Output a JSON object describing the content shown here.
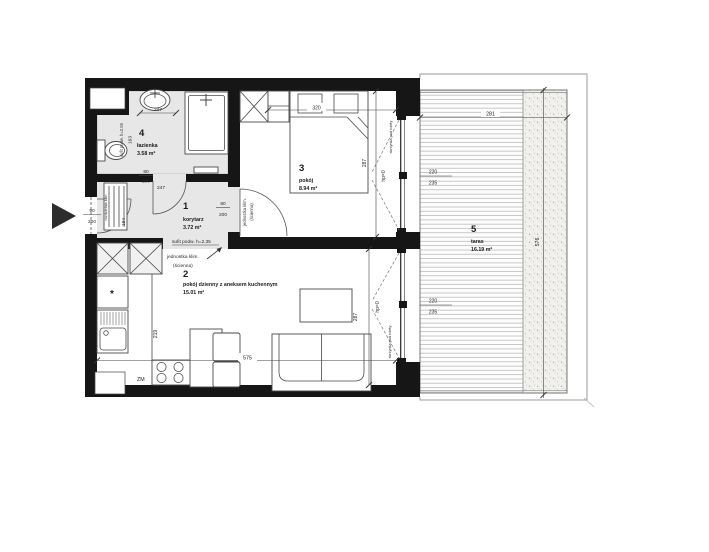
{
  "colors": {
    "wall": "#161616",
    "floor_gray": "#e7e7e7",
    "line": "#444444",
    "outline": "#9a9a9a"
  },
  "rooms": [
    {
      "number": "1",
      "name": "korytarz",
      "area": "3.72 m²"
    },
    {
      "number": "2",
      "name": "pokój dzienny z aneksem kuchennym",
      "area": "15.01 m²"
    },
    {
      "number": "3",
      "name": "pokój",
      "area": "8.94 m²"
    },
    {
      "number": "4",
      "name": "łazienka",
      "area": "3.58 m²"
    },
    {
      "number": "5",
      "name": "taras",
      "area": "16.19 m²"
    }
  ],
  "openings": {
    "entrance_w": "90",
    "entrance_h": "200",
    "door_w": "80",
    "door_h": "200",
    "window_w": "220",
    "window_h": "235"
  },
  "dims": {
    "basin": "247",
    "bath_door": "247",
    "bath_len": "163",
    "hall": "184",
    "bedroom_w": "320",
    "bedroom_d": "287",
    "kitchen_run": "219",
    "living_w": "575",
    "living_d": "287",
    "terrace_w": "281",
    "terrace_d": "576"
  },
  "notes": {
    "ceiling_bath": "sufit podw. h=2.55",
    "ceiling_hall": "sufit podw. h=2.35",
    "ac_unit": "jednostka klim.",
    "ac_mount": "(ścienna)",
    "ac_unit_v": "jednostka klim.",
    "ac_mount_v": "(ścienna)",
    "ac_distribution": "rozdzielnia klim.",
    "shutter_box_bedroom": "skrzynka pod rolety",
    "shutter_box_living": "skrzynka pod rolety",
    "sill_bedroom": "hp=0",
    "sill_living": "hp=0",
    "dishwasher": "ZM",
    "fridge_mark": "*"
  }
}
